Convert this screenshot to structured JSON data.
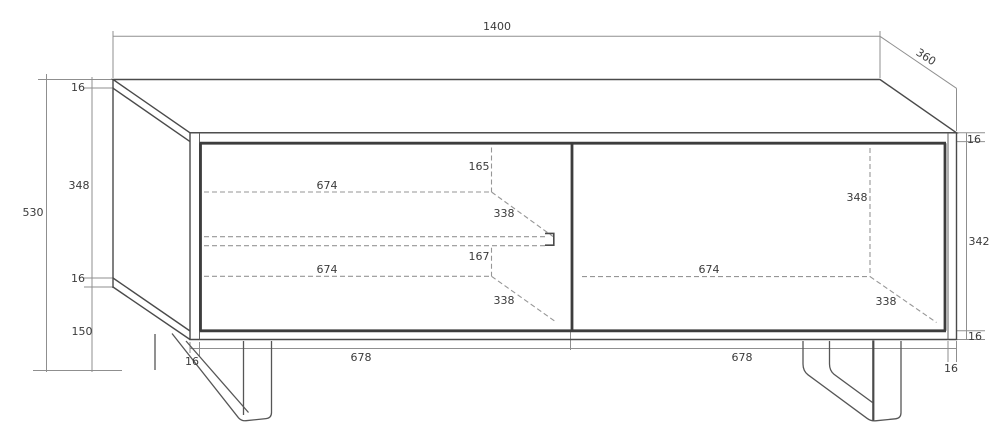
{
  "drawing": {
    "type": "furniture-technical-drawing",
    "units": "mm",
    "overall_dimensions": {
      "width": "1400",
      "depth": "360",
      "height": "530"
    },
    "panel_thickness": "16",
    "labels": [
      {
        "name": "overall-width",
        "text": "1400",
        "x": 497,
        "y": 30,
        "rotate": 0
      },
      {
        "name": "overall-depth",
        "text": "360",
        "x": 924,
        "y": 60,
        "rotate": 33
      },
      {
        "name": "overall-height",
        "text": "530",
        "x": 33,
        "y": 216,
        "rotate": 0
      },
      {
        "name": "top-panel-thickness-left",
        "text": "16",
        "x": 78,
        "y": 91,
        "rotate": 0
      },
      {
        "name": "side-panel-height",
        "text": "348",
        "x": 79,
        "y": 189,
        "rotate": 0
      },
      {
        "name": "bottom-panel-thickness-left",
        "text": "16",
        "x": 78,
        "y": 282,
        "rotate": 0
      },
      {
        "name": "leg-height",
        "text": "150",
        "x": 82,
        "y": 335,
        "rotate": 0
      },
      {
        "name": "top-panel-thickness-right",
        "text": "16",
        "x": 974,
        "y": 143,
        "rotate": 0
      },
      {
        "name": "interior-height-right-side",
        "text": "342",
        "x": 979,
        "y": 245,
        "rotate": 0
      },
      {
        "name": "bottom-panel-thickness-right",
        "text": "16",
        "x": 975,
        "y": 340,
        "rotate": 0
      },
      {
        "name": "side-panel-thickness-bottom-left",
        "text": "16",
        "x": 192,
        "y": 365,
        "rotate": 0
      },
      {
        "name": "door-width-left",
        "text": "678",
        "x": 361,
        "y": 361,
        "rotate": 0
      },
      {
        "name": "door-width-right",
        "text": "678",
        "x": 742,
        "y": 361,
        "rotate": 0
      },
      {
        "name": "side-panel-thickness-bottom-right",
        "text": "16",
        "x": 951,
        "y": 372,
        "rotate": 0
      },
      {
        "name": "shelf-clearance-top",
        "text": "165",
        "x": 479,
        "y": 170,
        "rotate": 0
      },
      {
        "name": "shelf-width-upper",
        "text": "674",
        "x": 327,
        "y": 189,
        "rotate": 0
      },
      {
        "name": "shelf-depth-upper",
        "text": "338",
        "x": 504,
        "y": 217,
        "rotate": 0
      },
      {
        "name": "shelf-clearance-bottom",
        "text": "167",
        "x": 479,
        "y": 260,
        "rotate": 0
      },
      {
        "name": "shelf-width-lower",
        "text": "674",
        "x": 327,
        "y": 273,
        "rotate": 0
      },
      {
        "name": "shelf-depth-lower",
        "text": "338",
        "x": 504,
        "y": 304,
        "rotate": 0
      },
      {
        "name": "interior-height-right-compartment",
        "text": "348",
        "x": 857,
        "y": 201,
        "rotate": 0
      },
      {
        "name": "interior-width-right",
        "text": "674",
        "x": 709,
        "y": 273,
        "rotate": 0
      },
      {
        "name": "interior-depth-right",
        "text": "338",
        "x": 886,
        "y": 305,
        "rotate": 0
      }
    ]
  }
}
